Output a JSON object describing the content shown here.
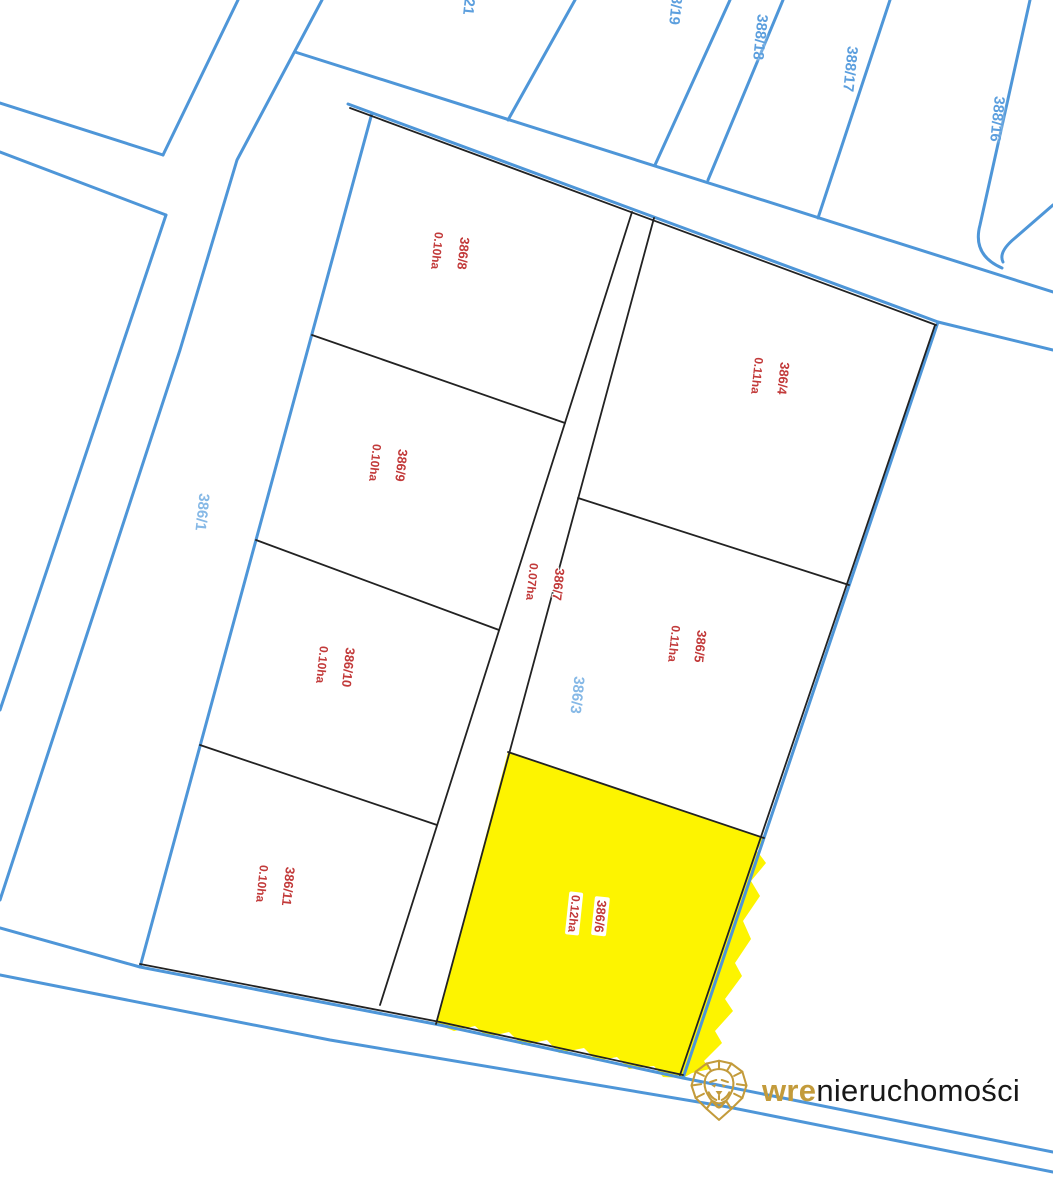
{
  "map": {
    "type": "cadastral-parcel-map",
    "colors": {
      "cadastral_line": "#4e96d8",
      "subdivision_line": "#222222",
      "highlight_fill": "#fdf400",
      "lot_label": "#c23a3a",
      "parcel_label_light": "#85b8e6",
      "parcel_label_blue": "#5c9fde"
    },
    "lots": [
      {
        "id": "386/8",
        "area": "0.10ha"
      },
      {
        "id": "386/9",
        "area": "0.10ha"
      },
      {
        "id": "386/10",
        "area": "0.10ha"
      },
      {
        "id": "386/11",
        "area": "0.10ha"
      },
      {
        "id": "386/7",
        "area": "0.07ha"
      },
      {
        "id": "386/4",
        "area": "0.11ha"
      },
      {
        "id": "386/5",
        "area": "0.11ha"
      },
      {
        "id": "386/6",
        "area": "0.12ha",
        "highlighted": true
      }
    ],
    "parcels": [
      {
        "id": "386/1"
      },
      {
        "id": "386/3"
      },
      {
        "id": "388/21"
      },
      {
        "id": "388/19"
      },
      {
        "id": "388/18"
      },
      {
        "id": "388/17"
      },
      {
        "id": "388/16"
      }
    ]
  },
  "logo": {
    "icon": "lion-icon",
    "brand_bold": "wre",
    "brand_rest": "nieruchomości",
    "gold": "#c39b3b"
  }
}
